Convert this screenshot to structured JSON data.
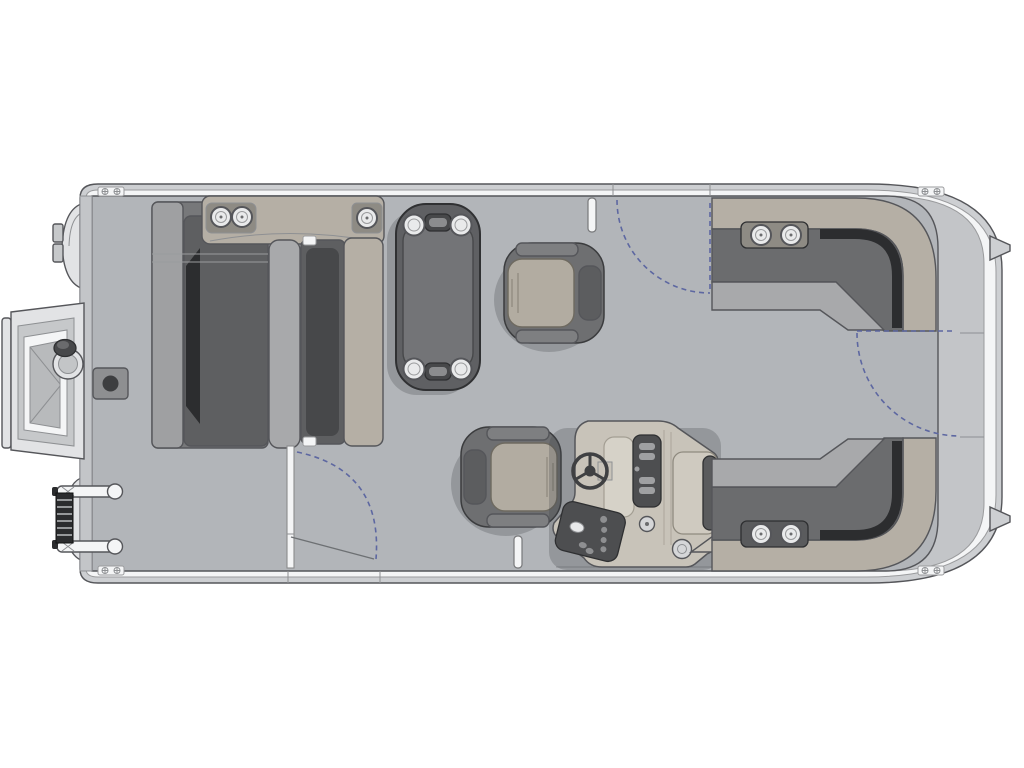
{
  "meta": {
    "title": "Pontoon boat floor plan - top view, bow at left",
    "diagram_type": "boat-floorplan"
  },
  "palette": {
    "background": "#ffffff",
    "outline": "#55565a",
    "hull_band": "#cdcfd2",
    "rub_rail_white": "#f4f5f6",
    "fence_gray": "#c3c5c8",
    "deck": "#b2b5b9",
    "upholstery_dark": "#6b6c6e",
    "cushion_panel": "#5e5f61",
    "cushion_shadow": "#2c2d2f",
    "seat_light": "#a8a9ab",
    "backrest_light": "#9fa0a2",
    "upholstery_tan": "#b5afa5",
    "plate_tan": "#8e8b84",
    "plate_dark": "#5a5b5d",
    "table_body": "#5f6063",
    "table_top": "#737477",
    "cup_white": "#e9eaeb",
    "chair_shell": "#6e6f71",
    "chair_seat": "#b2aca1",
    "headrest": "#5c5d5f",
    "armrest": "#7e7f81",
    "console_tan": "#c8c3b9",
    "console_panel_dark": "#4d4e50",
    "glovebox": "#cfcac0",
    "hardware_light": "#e2e3e5",
    "ladder_dark": "#2b2c2e",
    "swing_arc": "#5d67a1",
    "shadow": "rgba(60,64,68,0.26)"
  },
  "components": {
    "hull": {
      "label": "pontoon hull with fence and rub rail",
      "orientation": "bow-left"
    },
    "bow_lounge": {
      "label": "bow facing lounge group",
      "cup_holders": 3
    },
    "center_table": {
      "label": "removable cocktail table",
      "cup_holders": 4
    },
    "captain_chairs": {
      "count": 2,
      "labels": [
        "companion captain chair",
        "helm captain chair"
      ]
    },
    "helm_console": {
      "label": "helm console",
      "features": [
        "steering wheel",
        "instrument cluster",
        "switch panel",
        "glovebox",
        "speakers"
      ]
    },
    "aft_lounge_starboard": {
      "label": "aft L-lounge (top)",
      "cup_holders": 2
    },
    "aft_lounge_port": {
      "label": "aft L-lounge (bottom)",
      "cup_holders": 2
    },
    "gates": [
      "bow boarding ramp",
      "top side gate",
      "bottom side gate",
      "stern gate"
    ],
    "boarding_ladder": {
      "label": "folded boarding ladder",
      "state": "folded"
    },
    "tow_pylon": {
      "label": "tow pylon"
    },
    "pedestal_base": {
      "label": "table pedestal base plate"
    },
    "cup_holders_total": 11
  }
}
